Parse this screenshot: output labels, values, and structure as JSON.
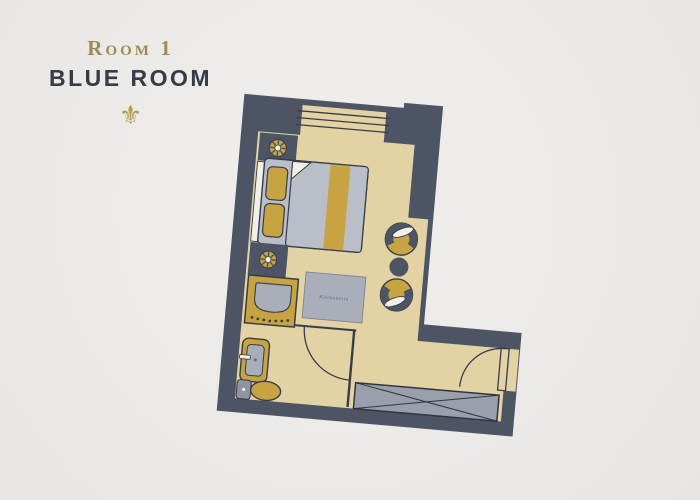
{
  "header": {
    "room_number": "Room 1",
    "room_name": "BLUE ROOM",
    "ornament_glyph": "⚜"
  },
  "floorplan": {
    "kitchenette_label": "Kitchenette"
  },
  "colors": {
    "paper": "#ecebe7",
    "wall": "#4d5564",
    "floor": "#e3d3a4",
    "gold": "#c7a441",
    "bed_gray": "#b9bec9",
    "unit_gray": "#a9aeb9",
    "wardrobe_gray": "#9aa0ab",
    "cream": "#f2efe6",
    "outline": "#363d4a",
    "title_gold": "#9d8b56",
    "title_dark": "#353b47",
    "ornament": "#b09a4f"
  }
}
